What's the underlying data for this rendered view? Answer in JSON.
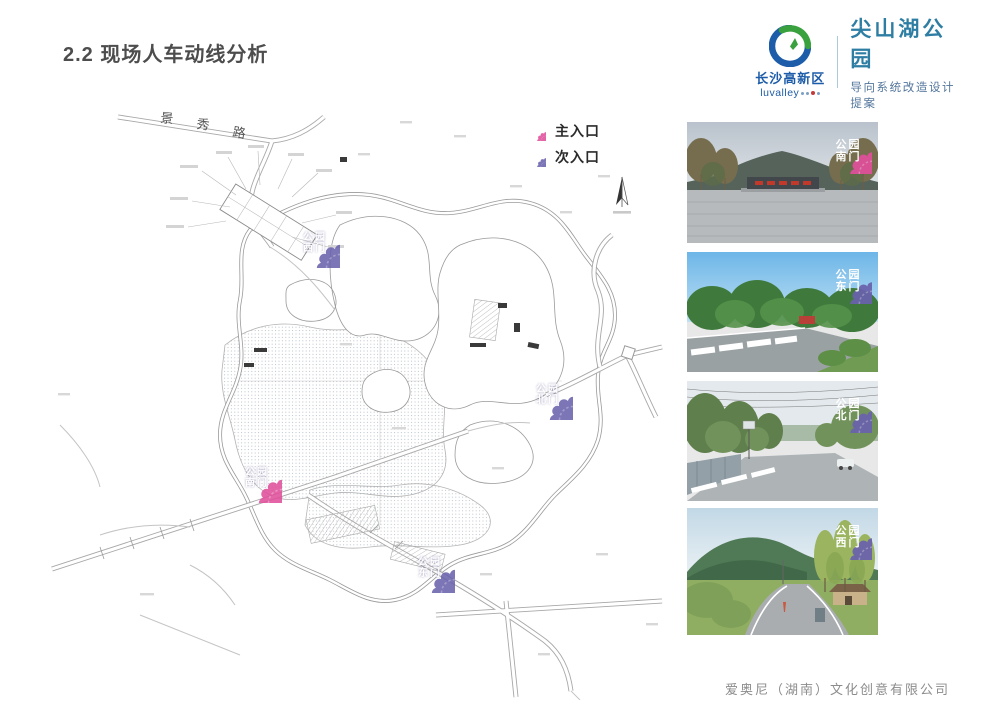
{
  "header": {
    "page_title": "2.2 现场人车动线分析",
    "logo": {
      "org_name": "长沙高新区",
      "org_latin": "luvalley"
    },
    "project": {
      "name": "尖山湖公园",
      "subtitle": "导向系统改造设计提案"
    }
  },
  "legend": {
    "items": [
      {
        "label": "主入口",
        "type": "main",
        "color": "#e04f9b"
      },
      {
        "label": "次入口",
        "type": "secondary",
        "color": "#6a62ad"
      }
    ]
  },
  "map": {
    "road_label_chars": [
      "景",
      "秀",
      "路"
    ],
    "markers": [
      {
        "line1": "公园",
        "line2": "西门",
        "type": "secondary"
      },
      {
        "line1": "公园",
        "line2": "北门",
        "type": "secondary"
      },
      {
        "line1": "公园",
        "line2": "南门",
        "type": "main"
      },
      {
        "line1": "公园",
        "line2": "东门",
        "type": "secondary"
      }
    ]
  },
  "photos": [
    {
      "line1": "公园",
      "line2": "南门",
      "type": "main"
    },
    {
      "line1": "公园",
      "line2": "东门",
      "type": "secondary"
    },
    {
      "line1": "公园",
      "line2": "北门",
      "type": "secondary"
    },
    {
      "line1": "公园",
      "line2": "西门",
      "type": "secondary"
    }
  ],
  "footer": {
    "company": "爱奥尼（湖南）文化创意有限公司"
  },
  "colors": {
    "main_entrance": "#e04f9b",
    "secondary_entrance": "#6a62ad",
    "brand_teal": "#2e7ea3",
    "brand_blue": "#1d5ca8"
  }
}
